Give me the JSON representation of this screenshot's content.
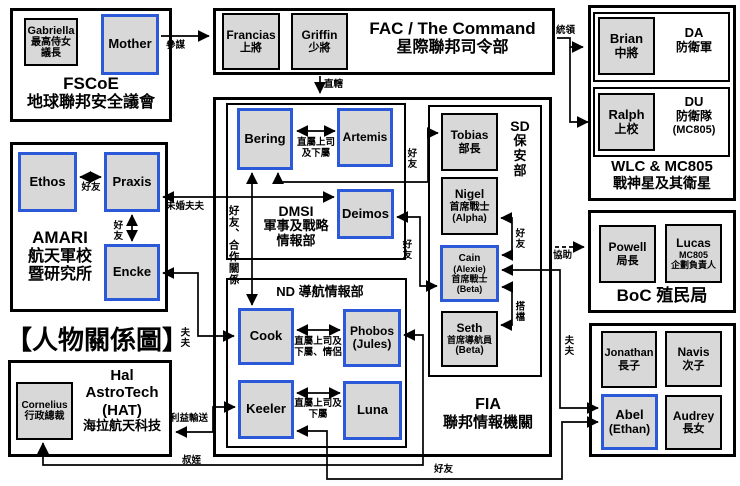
{
  "title": "【人物關係圖】",
  "colors": {
    "highlight_border": "#2b59d8",
    "person_fill": "#d8d8d8"
  },
  "orgs": {
    "fscoe": {
      "en": "FSCoE",
      "zh": "地球聯邦安全議會"
    },
    "fac": {
      "en": "FAC / The Command",
      "zh": "星際聯邦司令部"
    },
    "wlc": {
      "en": "WLC & MC805",
      "zh": "戰神星及其衛星",
      "da_en": "DA",
      "da_zh": "防衛軍",
      "du_en": "DU",
      "du_zh": "防衛隊",
      "du_note": "(MC805)"
    },
    "amari": {
      "en": "AMARI",
      "zh1": "航天軍校",
      "zh2": "暨研究所"
    },
    "fia": {
      "en": "FIA",
      "zh": "聯邦情報機關"
    },
    "dmsi": {
      "en": "DMSI",
      "zh1": "軍事及戰略",
      "zh2": "情報部"
    },
    "nd": {
      "label": "ND 導航情報部"
    },
    "sd": {
      "l1": "SD",
      "l2": "保",
      "l3": "安",
      "l4": "部"
    },
    "boc": {
      "label": "BoC 殖民局"
    },
    "hat": {
      "l1": "Hal",
      "l2": "AstroTech",
      "l3": "(HAT)",
      "l4": "海拉航天科技"
    }
  },
  "persons": {
    "gabriella": {
      "name": "Gabriella",
      "r1": "最高侍女",
      "r2": "議長"
    },
    "mother": {
      "name": "Mother"
    },
    "francias": {
      "name": "Francias",
      "r1": "上將"
    },
    "griffin": {
      "name": "Griffin",
      "r1": "少將"
    },
    "brian": {
      "name": "Brian",
      "r1": "中將"
    },
    "ralph": {
      "name": "Ralph",
      "r1": "上校"
    },
    "ethos": {
      "name": "Ethos"
    },
    "praxis": {
      "name": "Praxis"
    },
    "encke": {
      "name": "Encke"
    },
    "bering": {
      "name": "Bering"
    },
    "artemis": {
      "name": "Artemis"
    },
    "deimos": {
      "name": "Deimos"
    },
    "cook": {
      "name": "Cook"
    },
    "phobos": {
      "name": "Phobos",
      "r1": "(Jules)"
    },
    "keeler": {
      "name": "Keeler"
    },
    "luna": {
      "name": "Luna"
    },
    "tobias": {
      "name": "Tobias",
      "r1": "部長"
    },
    "nigel": {
      "name": "Nigel",
      "r1": "首席戰士",
      "r2": "(Alpha)"
    },
    "cain": {
      "name": "Cain",
      "r1": "(Alexie)",
      "r2": "首席戰士",
      "r3": "(Beta)"
    },
    "seth": {
      "name": "Seth",
      "r1": "首席導航員",
      "r2": "(Beta)"
    },
    "powell": {
      "name": "Powell",
      "r1": "局長"
    },
    "lucas": {
      "name": "Lucas",
      "r1": "MC805",
      "r2": "企劃負責人"
    },
    "jonathan": {
      "name": "Jonathan",
      "r1": "長子"
    },
    "navis": {
      "name": "Navis",
      "r1": "次子"
    },
    "abel": {
      "name": "Abel",
      "r1": "(Ethan)"
    },
    "audrey": {
      "name": "Audrey",
      "r1": "長女"
    },
    "cornelius": {
      "name": "Cornelius",
      "r1": "行政總裁"
    }
  },
  "edges": {
    "canmou": "參謀",
    "zhixia": "直轄",
    "tongling": "統領",
    "bering_artemis_1": "直屬上司",
    "bering_artemis_2": "及下屬",
    "ethos_praxis": "好友",
    "praxis_encke": "好友",
    "weihunfufu": "未婚夫夫",
    "encke_cook": "夫夫",
    "bering_cook": "好友、合作關係",
    "bering_tobias": "好友",
    "deimos_cain": "好友",
    "nigel_cain": "好友",
    "cain_seth": "搭檔",
    "cain_abel": "夫夫",
    "xiezhu": "協助",
    "cook_phobos_1": "直屬上司及",
    "cook_phobos_2": "下屬、情侶",
    "keeler_luna_1": "直屬上司及",
    "keeler_luna_2": "下屬",
    "liyishusong": "利益輸送",
    "shuzhi": "叔姪",
    "keeler_abel": "好友"
  }
}
